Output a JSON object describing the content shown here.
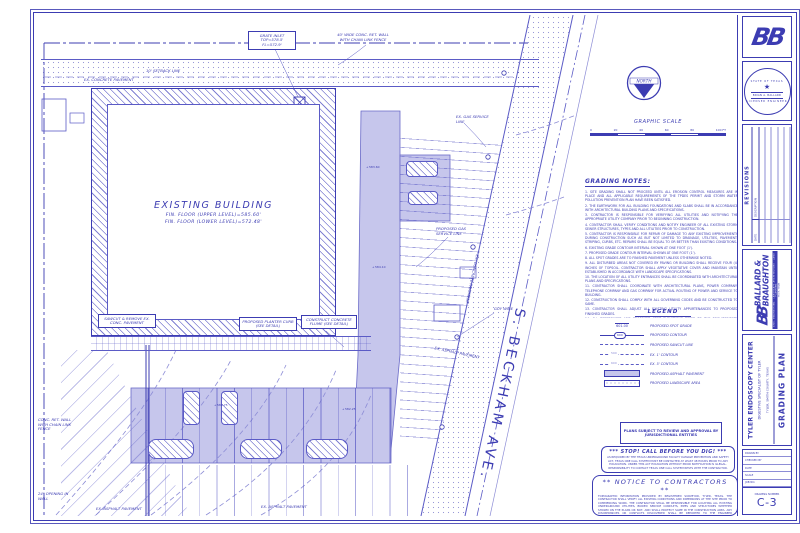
{
  "title_block": {
    "logo_text": "BB",
    "seal": {
      "state": "STATE OF TEXAS",
      "star": "★",
      "name": "BRIAN A. BALLARD",
      "title": "LICENSED ENGINEER"
    },
    "revisions": {
      "title": "REVISIONS",
      "col_date": "DATE",
      "col_desc": "DESCRIPTION"
    },
    "firm": {
      "logo_text": "BB",
      "name_line1": "BALLARD &",
      "name_line2": "BRAUGHTON",
      "tagline": "CIVIL ENGINEERING · LANDSCAPE ARCHITECTURE · LAND PLANNING",
      "address": "TYLER, TEXAS"
    },
    "project": {
      "name": "TYLER ENDOSCOPY CENTER",
      "sub": "DIGESTIVE SPECIALIST OF TYLER",
      "location": "TYLER, SMITH COUNTY, TEXAS",
      "sheet_title": "GRADING PLAN"
    },
    "info": {
      "fields": [
        "DRAWN BY",
        "CHECKED BY",
        "DATE",
        "SCALE",
        "JOB NO."
      ],
      "drawing_number_label": "DRAWING NUMBER",
      "drawing_number": "C-3"
    }
  },
  "north_arrow": {
    "label": "NORTH"
  },
  "graphic_scale": {
    "title": "GRAPHIC SCALE",
    "ticks": [
      "0",
      "20",
      "40",
      "60",
      "80",
      "100 FT"
    ]
  },
  "grading_notes": {
    "title": "GRADING NOTES:",
    "items": [
      "1. SITE GRADING SHALL NOT PROCEED UNTIL ALL EROSION CONTROL MEASURES ARE IN PLACE AND ALL APPLICABLE REQUIREMENTS OF THE TPDES PERMIT AND STORM WATER POLLUTION PREVENTION PLAN HAVE BEEN SATISFIED.",
      "2. THE EARTHWORK FOR ALL BUILDING FOUNDATIONS AND SLABS SHALL BE IN ACCORDANCE WITH ARCHITECTURAL BUILDING PLANS AND SPECIFICATIONS.",
      "3. CONTRACTOR IS RESPONSIBLE FOR VERIFYING ALL UTILITIES AND NOTIFYING THE APPROPRIATE UTILITY COMPANY PRIOR TO BEGINNING CONSTRUCTION.",
      "4. CONTRACTOR SHALL VERIFY CONDITIONS AND NOTIFY ENGINEER OF ALL EXISTING STORM SEWER STRUCTURES, TYPES AND ALL UTILITIES PRIOR TO CONSTRUCTION.",
      "5. CONTRACTOR IS RESPONSIBLE FOR REPAIR OF DAMAGE TO ANY EXISTING IMPROVEMENTS DURING CONSTRUCTION SUCH AS BUT NOT LIMITED TO DRAINAGE, UTILITIES, PAVEMENT, STRIPING, CURBS, ETC. REPAIRS SHALL BE EQUAL TO OR BETTER THAN EXISTING CONDITIONS.",
      "6. EXISTING GRADE CONTOUR INTERVAL SHOWN AT ONE FOOT (1').",
      "7. PROPOSED GRADE CONTOUR INTERVAL SHOWN AT ONE FOOT (1').",
      "8. ALL SPOT GRADES ARE TO FINISHED PAVEMENT UNLESS OTHERWISE NOTED.",
      "9. ALL DISTURBED AREAS NOT COVERED BY PAVING OR BUILDING SHALL RECEIVE FOUR (4) INCHES OF TOPSOIL. CONTRACTOR SHALL APPLY VEGETATIVE COVER AND MAINTAIN UNTIL ESTABLISHED IN ACCORDANCE WITH LANDSCAPE SPECIFICATIONS.",
      "10. THE LOCATION OF ALL UTILITY ENTRANCES SHALL BE COORDINATED WITH ARCHITECTURAL PLANS AND SPECIFICATIONS.",
      "11. CONTRACTOR SHALL COORDINATE WITH ARCHITECTURAL PLANS, POWER COMPANY, TELEPHONE COMPANY AND GAS COMPANY FOR ACTUAL ROUTING OF POWER AND SERVICE TO BUILDING.",
      "12. CONSTRUCTION SHALL COMPLY WITH ALL GOVERNING CODES AND BE CONSTRUCTED TO SAME.",
      "13. CONTRACTOR SHALL ADJUST ALL EXISTING UTILITY APPURTENANCES TO PROPOSED FINISHED GRADES.",
      "14. ALL REFERENCED AND PROPOSED SPOT ELEVATIONS REFER TO THE REQUIREMENTS SPECIFIED IN THE GEOTECHNICAL REPORT PREPARED BY AREA ENGINEERING, INC.",
      "15. FOR PROPOSED CURB ADJACENT TO EXISTING PAVEMENT CONTRACTOR SHALL MATCH EXISTING GRADES. CURB TOP SHALL BE SLOPED TO MATCH SLOPE OF ADJACENT PAVING."
    ]
  },
  "legend": {
    "title": "LEGEND",
    "items": [
      {
        "sample": "601.00",
        "label": "PROPOSED SPOT GRADE"
      },
      {
        "sample": "600",
        "label": "PROPOSED CONTOUR"
      },
      {
        "sample": "",
        "label": "PROPOSED SAWCUT LINE"
      },
      {
        "sample": "590",
        "label": "EX. 1' CONTOUR"
      },
      {
        "sample": "600",
        "label": "EX. 5' CONTOUR"
      },
      {
        "sample": "",
        "label": "PROPOSED ASPHALT PAVEMENT"
      },
      {
        "sample": "",
        "label": "PROPOSED LANDSCAPE AREA"
      }
    ]
  },
  "boxes": {
    "jurisdiction": "PLANS SUBJECT TO REVIEW AND APPROVAL BY JURISDICTIONAL ENTITIES",
    "stop": {
      "title": "***   STOP!   CALL BEFORE YOU DIG!   ***",
      "body": "AS REQUIRED BY THE TEXAS UNDERGROUND FACILITY DAMAGE PREVENTION AND SAFETY ACT, TEXAS ONE CALL SYSTEM MUST BE CONTACTED AT LEAST 48 HOURS PRIOR TO ANY EXCAVATION. UNDER THIS ACT EXCAVATION WITHOUT PRIOR NOTIFICATION IS ILLEGAL. RESPONSIBILITY TO CONTACT TEXAS ONE CALL SYSTEM RESTS WITH THE CONTRACTOR."
    },
    "notice": {
      "title": "**   NOTICE  TO  CONTRACTORS   **",
      "body": "TOPOGRAPHIC INFORMATION PROVIDED BY REGISTERED SURVEYOR, TYLER, TEXAS. THE CONTRACTOR SHALL VERIFY ALL EXISTING CONDITIONS AND DIMENSIONS AT THE SITE PRIOR TO COMMENCING WORK. THE CONTRACTOR SHALL BE RESPONSIBLE FOR LOCATING ALL EXISTING UNDERGROUND UTILITIES, BURIED SERVICE CONDUITS, PIPES AND STRUCTURES WHETHER SHOWN ON THE PLANS OR NOT, AND SHALL PROTECT SAME IN THE CONSTRUCTION AREA. ANY DISCREPANCIES OR CONFLICTS DISCOVERED SHALL BE REPORTED TO THE ENGINEER IMMEDIATELY. FAILURE TO COMPLY SHALL RESULT IN THE CONTRACTOR ASSUMING FULL RESPONSIBILITY FOR ANY DAMAGES INCURRED."
    }
  },
  "site": {
    "street": "S. BECKHAM AVE.",
    "building": {
      "line1": "EXISTING BUILDING",
      "line2": "FIN. FLOOR (UPPER LEVEL)=585.60'",
      "line3": "FIN. FLOOR (LOWER LEVEL)=572.48'"
    },
    "labels": {
      "ex_concrete": "EX. CONCRETE PAVEMENT",
      "ret_wall_top": "40' WIDE CONC. RET. WALL WITH CHAIN LINK FENCE",
      "setback": "10' SETBACK LINE",
      "grate_inlet": "GRATE INLET TOP=578.5' FL=572.9'",
      "gas_ex": "EX. GAS SERVICE LINE",
      "gas_prop": "PROPOSED GAS SERVICE LINE",
      "ex_asphalt": "EX. ASPHALT PAVEMENT",
      "guy_wire": "GUY WIRE",
      "ret_wall_left": "CONC. RET. WALL WITH CHAIN LINK FENCE",
      "opening": "24\" OPENING IN WALL",
      "callout_sawcut": "SAWCUT & REMOVE EX. CONC. PAVEMENT",
      "callout_curb": "PROPOSED PLANTER CURB (SEE DETAIL)",
      "callout_flume": "CONSTRUCT CONCRETE FLUME (SEE DETAIL)"
    },
    "spots": {
      "a": "583.60",
      "b": "584.10",
      "c": "582.25",
      "d": "580.75"
    }
  }
}
